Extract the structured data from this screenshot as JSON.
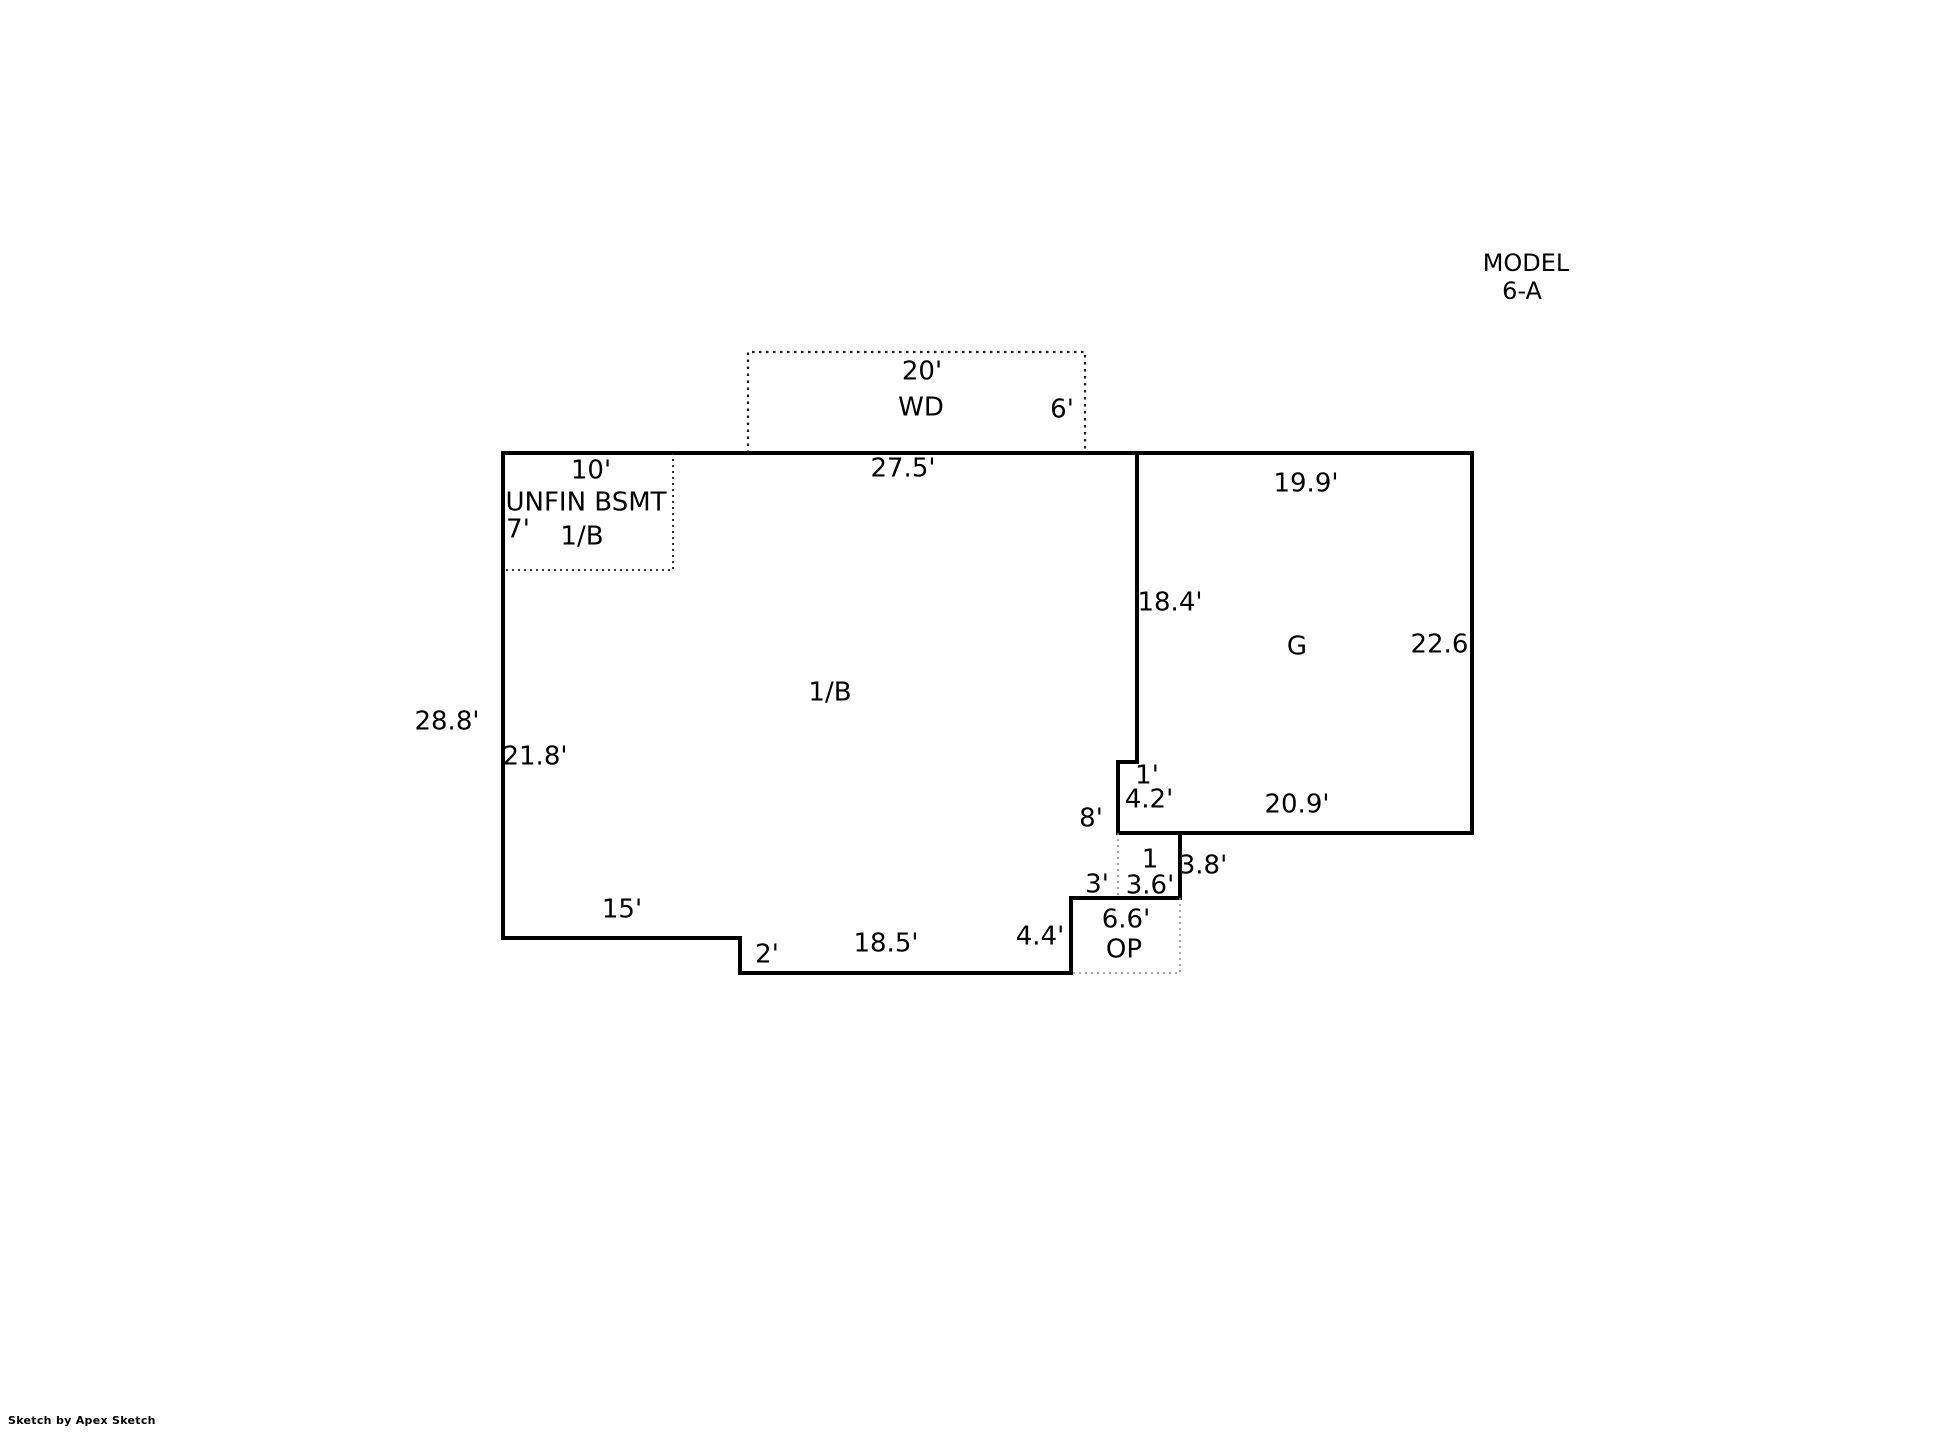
{
  "title": {
    "line1": "MODEL",
    "line2": "6-A"
  },
  "footer": {
    "credit": "Sketch by Apex Sketch"
  },
  "colors": {
    "wall": "#000000",
    "dotted": "#1a1a1a",
    "dotted_light": "#8a8a8a"
  },
  "deck": {
    "label": "WD",
    "width": "20'",
    "depth": "6'"
  },
  "basement": {
    "name": "UNFIN BSMT",
    "code": "1/B",
    "width": "10'",
    "depth": "7'"
  },
  "main": {
    "code": "1/B",
    "top": "27.5'",
    "left": "28.8'",
    "left_inner": "21.8'",
    "east": "8'",
    "bottom_west": "15'",
    "step_south": "2'",
    "bottom_mid": "18.5'",
    "step_east": "4.4'",
    "bottom_east": "3'"
  },
  "garage": {
    "label": "G",
    "top": "19.9'",
    "left": "18.4'",
    "right": "22.6'",
    "bottom": "20.9'",
    "notch_step": "1'",
    "notch_depth": "4.2'"
  },
  "stoop": {
    "label": "1",
    "right": "3.8'",
    "bottom": "3.6'"
  },
  "porch": {
    "label": "OP",
    "width": "6.6'"
  }
}
